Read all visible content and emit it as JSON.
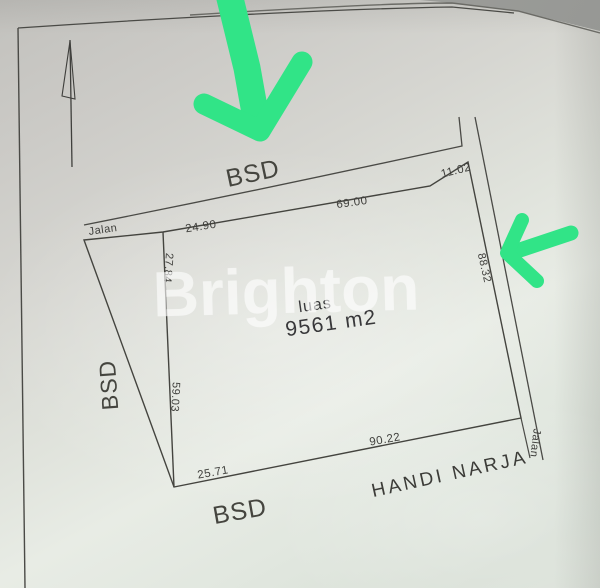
{
  "watermark": "Brighton",
  "plot": {
    "area_label": "luas",
    "area_value": "9561 m2",
    "owner_name": "HANDI NARJA"
  },
  "roads": {
    "top_name": "BSD",
    "left_name": "BSD",
    "bottom_name": "BSD",
    "top_left_street": "Jalan",
    "right_street": "Jalan"
  },
  "measurements": {
    "top_left": "24.90",
    "top_mid": "69.00",
    "top_right": "11.02",
    "left_upper": "27.84",
    "left_lower": "59.03",
    "right_side": "88.32",
    "bottom_left": "25.71",
    "bottom_mid": "90.22"
  },
  "colors": {
    "annotation_green": "#31e487",
    "drawing_line": "#4a4a46",
    "paper": "#e0e4dd"
  }
}
